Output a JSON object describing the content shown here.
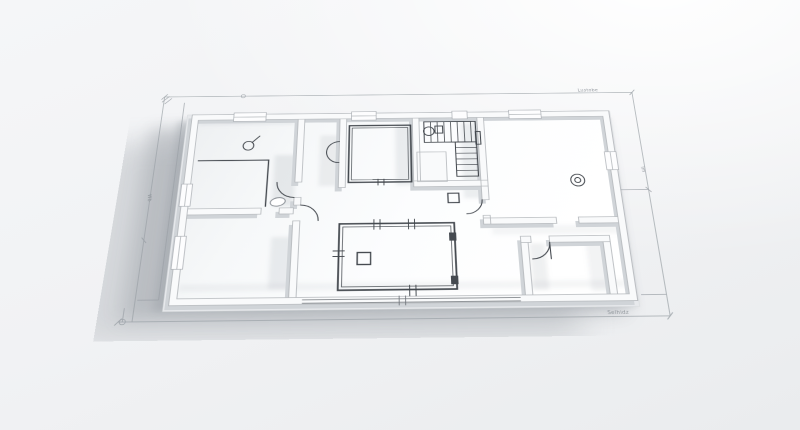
{
  "scene": {
    "type": "3d-architectural-floor-plan-render",
    "surface": {
      "base_color": "#f1f2f4",
      "highlight_color": "#ffffff"
    },
    "model": {
      "floor_color": "#fbfcfd",
      "wall_top_color": "#f9fafb",
      "wall_edge_color": "#b2b6ba",
      "wall_side_color": "#d0d4d8",
      "linework_color": "#41464c",
      "ground_shadow_color": "#8b9198"
    },
    "dimension_annotations": {
      "color": "#9aa0a6",
      "top_label": "Lustobe",
      "bottom_label": "Selhidz",
      "left_label": "Wb",
      "right_label": "lm"
    },
    "symbols": [
      "staircase",
      "door-swing-arc",
      "ceiling-light",
      "toilet",
      "sink-oval",
      "column-square",
      "skylight-window",
      "wall-window",
      "dimension-line",
      "survey-circle-marker"
    ]
  }
}
